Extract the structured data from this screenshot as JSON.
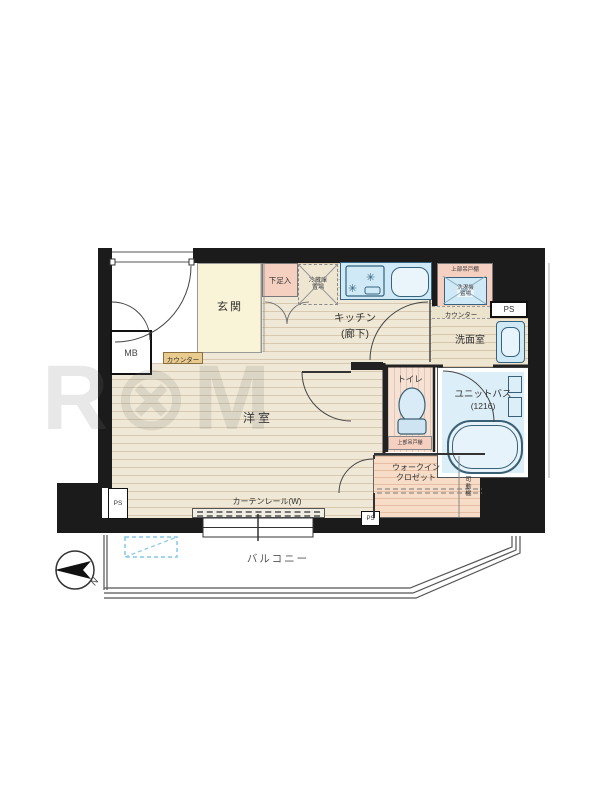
{
  "watermark": "R⊗M C⊗RE",
  "colors": {
    "wall": "#1b1b1b",
    "floor_beige": "#f0e8d6",
    "genkan_yellow": "#f9f4d8",
    "fixture_blue": "#cfe9f6",
    "pink": "#f5cfc0",
    "wic_pink": "#f7ddc8",
    "counter_tan": "#eacb8e",
    "bath_floor": "#dceef8",
    "hatch_blue": "#85c7e8"
  },
  "rooms": {
    "genkan": "玄関",
    "kitchen_line1": "キッチン",
    "kitchen_line2": "(廊下)",
    "western_room": "洋室",
    "washroom": "洗面室",
    "toilet": "トイレ",
    "unit_bath_line1": "ユニットバス",
    "unit_bath_line2": "(1216)",
    "wic_line1": "ウォークイン",
    "wic_line2": "クロゼット",
    "balcony": "バルコニー"
  },
  "fixtures": {
    "shoe_box": "下足入",
    "fridge_line1": "冷蔵庫",
    "fridge_line2": "置場",
    "upper_cabinet": "上部吊戸棚",
    "washer_line1": "洗濯機",
    "washer_line2": "置場",
    "counter_right": "カウンター",
    "counter_left": "カウンター",
    "toilet_upper_cabinet": "上部吊戸棚",
    "movable_shelf": "可動棚",
    "curtain_rail": "カーテンレール(W)"
  },
  "utilities": {
    "ps_top": "PS",
    "ps_left": "PS",
    "ps_bottom": "PS",
    "mb": "MB"
  },
  "icons": {
    "burner": "✳"
  },
  "compass": {
    "north": "N"
  }
}
